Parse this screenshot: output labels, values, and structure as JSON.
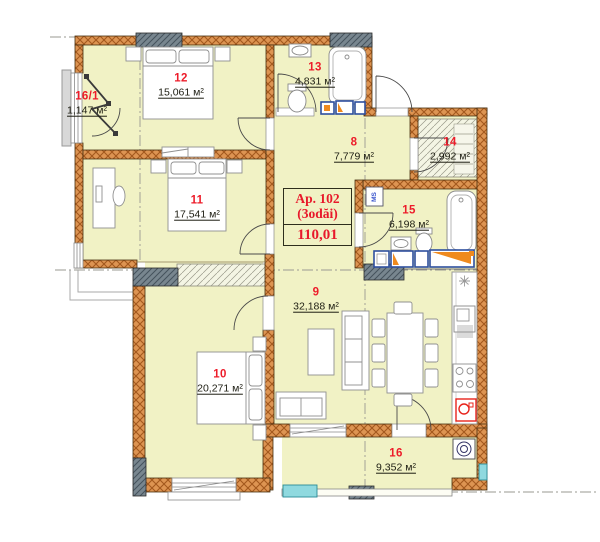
{
  "plan": {
    "apartment": {
      "line1": "Ap. 102",
      "line2": "(3odăi)",
      "total_area": "110,01"
    },
    "shaft_label": "MS",
    "rooms": [
      {
        "number": "12",
        "area_text": "15,061 м²"
      },
      {
        "number": "16/1",
        "area_text": "1,147 м²"
      },
      {
        "number": "11",
        "area_text": "17,541 м²"
      },
      {
        "number": "13",
        "area_text": "4,831 м²"
      },
      {
        "number": "8",
        "area_text": "7,779 м²"
      },
      {
        "number": "14",
        "area_text": "2,992 м²"
      },
      {
        "number": "15",
        "area_text": "6,198 м²"
      },
      {
        "number": "9",
        "area_text": "32,188 м²"
      },
      {
        "number": "10",
        "area_text": "20,271 м²"
      },
      {
        "number": "16",
        "area_text": "9,352 м²"
      }
    ],
    "colors": {
      "room_fill": "#f1f2c5",
      "wall_brick": "#dd9452",
      "concrete_gray": "#78868f",
      "number_red": "#ed1c2a",
      "area_text": "#1d1d12",
      "accent_cyan": "#8fd9df",
      "vanity_blue": "#2e4f9e",
      "vanity_orange": "#ef8a1e",
      "boiler_red": "#e8241c"
    }
  }
}
